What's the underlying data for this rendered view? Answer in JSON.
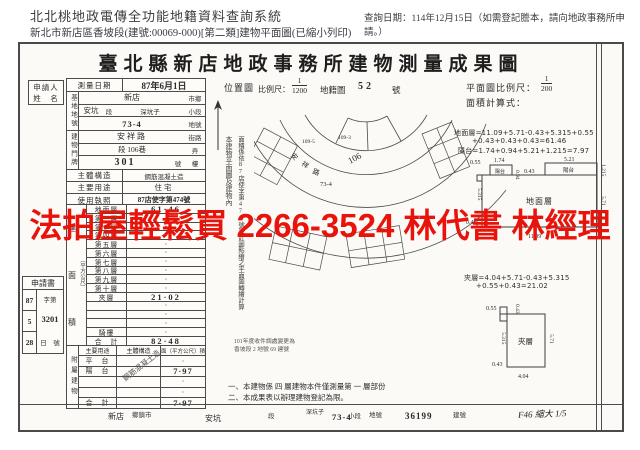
{
  "header": {
    "system_title": "北北桃地政電傳全功能地籍資料查詢系統",
    "subtitle": "新北市新店區香坡段(建號:00069-000)[第二類]建物平面圖(已縮小列印)",
    "query_date": "查詢日期：114年12月15日（如需登記謄本，請向地政事務所申請。）"
  },
  "watermark": {
    "text": "法拍屋輕鬆買 2266-3524 林代書 林經理",
    "color": "#e8130b"
  },
  "document": {
    "title": "臺北縣新店地政事務所建物測量成果圖"
  },
  "applicant": {
    "line1": "申請人",
    "line2": "姓　名"
  },
  "survey": {
    "label": "測量日期",
    "value": "87年6月1日"
  },
  "land": {
    "label": "基地地號",
    "row1_value": "新店",
    "row1_suffix": "市鄉",
    "row2_pre": "安坑",
    "row2_mid": "段",
    "row2_value": "深坑子",
    "row2_suffix": "小段",
    "row3_value": "73-4",
    "row3_suffix": "地號"
  },
  "address": {
    "label": "建物門牌",
    "row1_value": "安祥路",
    "row1_suffix": "街路",
    "row2_value": "段 106巷",
    "row2_suffix": "弄",
    "row3_value": "301",
    "row3_mid": "號",
    "row3_suffix": "樓"
  },
  "structure": {
    "label": "主體構造",
    "value": "鋼筋混凝土造"
  },
  "usage": {
    "label": "主要用途",
    "value": "住宅"
  },
  "license": {
    "label": "使用執照",
    "value": "87店使字第474號"
  },
  "floor_area": {
    "label_c1": "建",
    "label_c2": "面",
    "label_c3": "積",
    "unit": "（平方公尺）",
    "rows": [
      {
        "label": "地面層",
        "value": "61·46"
      },
      {
        "label": "第二層",
        "value": "·"
      },
      {
        "label": "第三層",
        "value": "·"
      },
      {
        "label": "第四層",
        "value": "·"
      },
      {
        "label": "第五層",
        "value": "·"
      },
      {
        "label": "第六層",
        "value": "·"
      },
      {
        "label": "第七層",
        "value": "·"
      },
      {
        "label": "第八層",
        "value": "·"
      },
      {
        "label": "第九層",
        "value": "·"
      },
      {
        "label": "第十層",
        "value": "·"
      },
      {
        "label": "夾層",
        "value": "21·02"
      },
      {
        "label": "",
        "value": "·"
      },
      {
        "label": "",
        "value": "·"
      },
      {
        "label": "",
        "value": "·"
      },
      {
        "label": "騎樓",
        "value": "·"
      },
      {
        "label": "合　計",
        "value": "82·48"
      }
    ]
  },
  "application": {
    "label": "申請書",
    "year": "87",
    "month": "5",
    "day": "28",
    "doc_prefix": "字第",
    "doc_number": "3201",
    "doc_suffix": "日　號"
  },
  "annex": {
    "label": "附屬建物",
    "col_use": "主要用途",
    "col_structure": "主體構造",
    "col_area": "面（平方公尺）積",
    "stamp": "鋼筋混凝土造",
    "rows": [
      {
        "use": "平　台",
        "area": "·"
      },
      {
        "use": "陽　台",
        "area": "7·97"
      },
      {
        "use": "",
        "area": "·"
      },
      {
        "use": "",
        "area": "·"
      },
      {
        "use": "合　計",
        "area": "7·97"
      }
    ]
  },
  "location_map": {
    "label": "位置圖",
    "scale_label": "比例尺：",
    "scale_num": "1",
    "scale_den": "1200",
    "sheet_label": "地籍圖",
    "sheet_no": "52",
    "sheet_suffix": "號",
    "road_char1": "安",
    "road_char2": "祥",
    "road_char3": "路",
    "road_no": "106",
    "lot_a": "109-5",
    "lot_b": "109-3",
    "lot_main": "73-4"
  },
  "side_note": {
    "col1": "本建物平面圖及建物內",
    "col2": "面積係依87店使字第474號設計圖點繪之平面圖轉繪計算"
  },
  "small_note": {
    "line1": "101年度收件調處變更為",
    "line2": "香坡段 2 地號 69 建號"
  },
  "plan": {
    "scale_label": "平面圖比例尺：",
    "scale_num": "1",
    "scale_den": "200",
    "calc_label": "面積計算式：",
    "ground_calc_line1": "地面層=11.09+5.71-0.43+5.315+0.55",
    "ground_calc_line2": "+0.43+0.43+0.43=61.46",
    "balcony_calc": "陽台=1.74+0.94+5.21+1.215=7.97",
    "mezz_calc_line1": "夾層=4.04+5.71-0.43+5.315",
    "mezz_calc_line2": "+0.55+0.43=21.02",
    "ground_label": "地面層",
    "balcony_label": "陽台",
    "mezz_label": "夾層",
    "dims": {
      "d055": "0.55",
      "d174": "1.74",
      "d094": "0.94",
      "d043": "0.43",
      "d521": "5.21",
      "d1215": "1.215",
      "d5315": "5.315",
      "d1109": "11.09",
      "d571": "5.71",
      "d404": "4.04"
    }
  },
  "notes": {
    "line1": "一、本建物係 四 層建物本件僅測量第 一 層部份",
    "line2": "二、本成果表以辦理建物登記為限。"
  },
  "footer": {
    "town_value": "新店",
    "town_label": "鄉鎮市",
    "section_value": "安坑",
    "section_label": "段",
    "subsection_value": "深坑子",
    "subsection_label": "小段",
    "lot_value": "73-4",
    "lot_label": "地號",
    "building_no": "36199",
    "building_label": "建號",
    "handwritten": "F46 縮大 1/5"
  }
}
